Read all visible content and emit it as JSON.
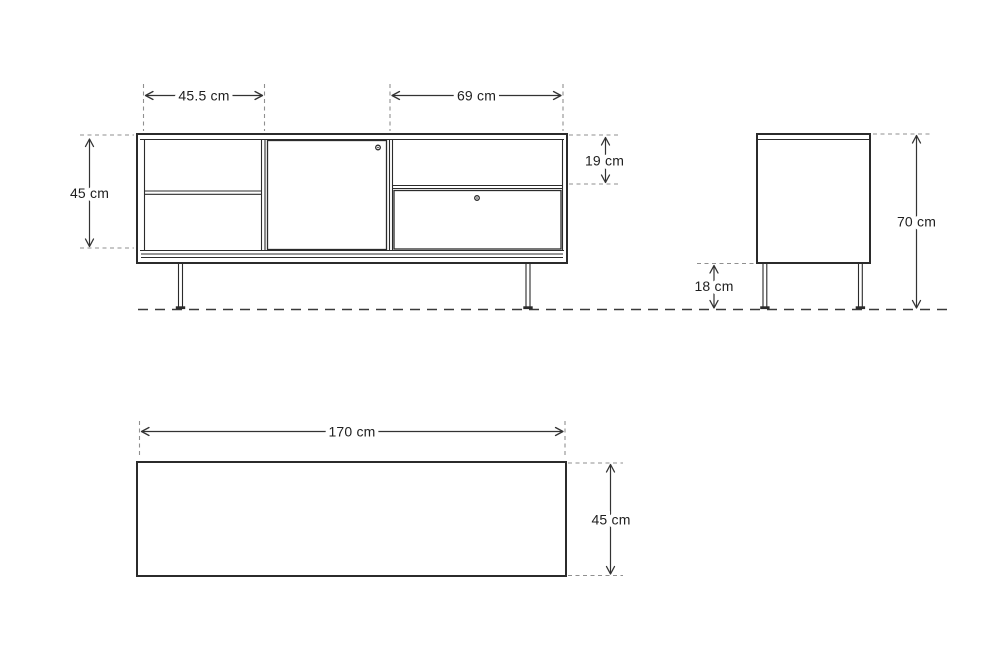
{
  "diagram": {
    "type": "furniture-dimension-drawing",
    "colors": {
      "line": "#2b2b2b",
      "dimension_line": "#333333",
      "extension_dash": "#8f8f8f",
      "ground_dash": "#3a3a3a",
      "text": "#1f1f1f",
      "background": "#ffffff"
    },
    "icons": {
      "door_knob": "knob-icon",
      "drawer_knob": "knob-icon"
    },
    "front_view": {
      "left_section_width": "45.5 cm",
      "right_section_width": "69 cm",
      "interior_height": "45 cm",
      "top_drawer_height": "19 cm"
    },
    "side_view": {
      "overall_height": "70 cm",
      "leg_height": "18 cm"
    },
    "top_view": {
      "width": "170 cm",
      "depth": "45 cm"
    }
  }
}
